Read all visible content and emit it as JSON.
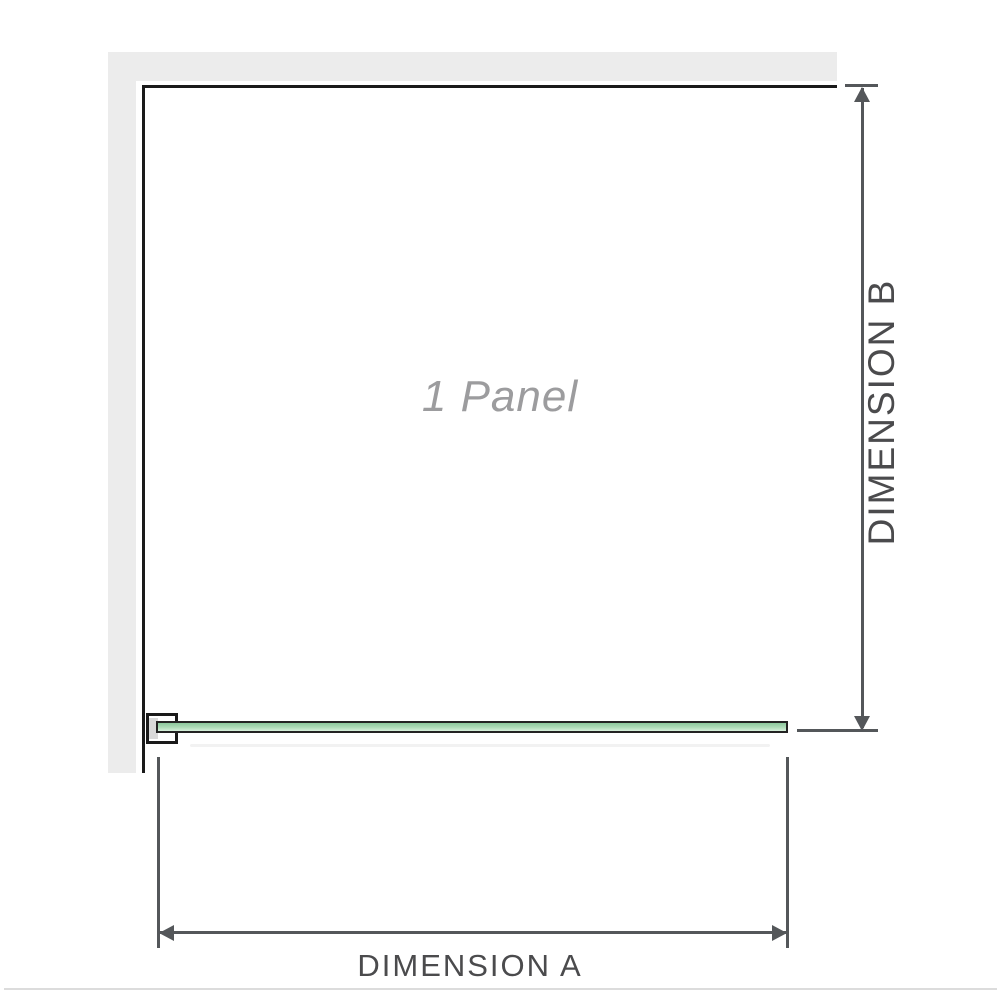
{
  "diagram": {
    "panel_label": "1 Panel",
    "dimension_a_label": "DIMENSION A",
    "dimension_b_label": "DIMENSION B"
  },
  "colors": {
    "wall": "#ececec",
    "outline": "#1a1a1a",
    "dimension": "#54575a",
    "label": "#4b4b4d",
    "panel_text": "#9c9c9e",
    "glass_border": "#232323",
    "glass_top": "#8cc89c",
    "glass_mid": "#aedbb8",
    "glass_bottom": "#d8f0dc",
    "baseline": "#dcdcdc"
  }
}
